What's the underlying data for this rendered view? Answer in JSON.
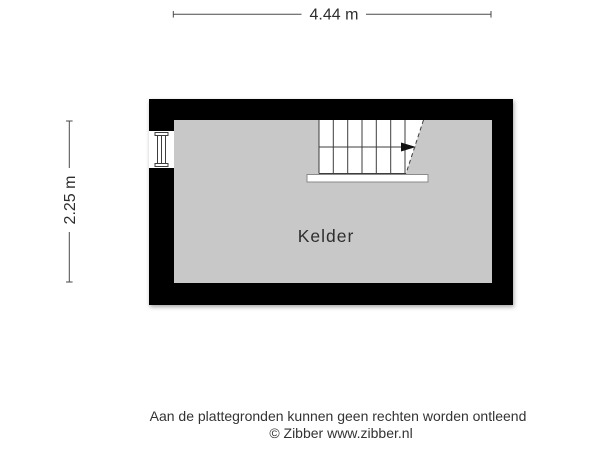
{
  "floorplan": {
    "room_label": "Kelder",
    "width_dimension": "4.44 m",
    "height_dimension": "2.25 m"
  },
  "footer": {
    "disclaimer": "Aan de plattegronden kunnen geen rechten worden ontleend",
    "copyright": "© Zibber www.zibber.nl"
  },
  "colors": {
    "wall": "#000000",
    "floor": "#c8c8c8",
    "line": "#3d3d3d",
    "background": "#ffffff"
  },
  "icons": {
    "staircase": "staircase-symbol",
    "window": "window-symbol",
    "stair_arrow": "arrow-right-icon"
  }
}
